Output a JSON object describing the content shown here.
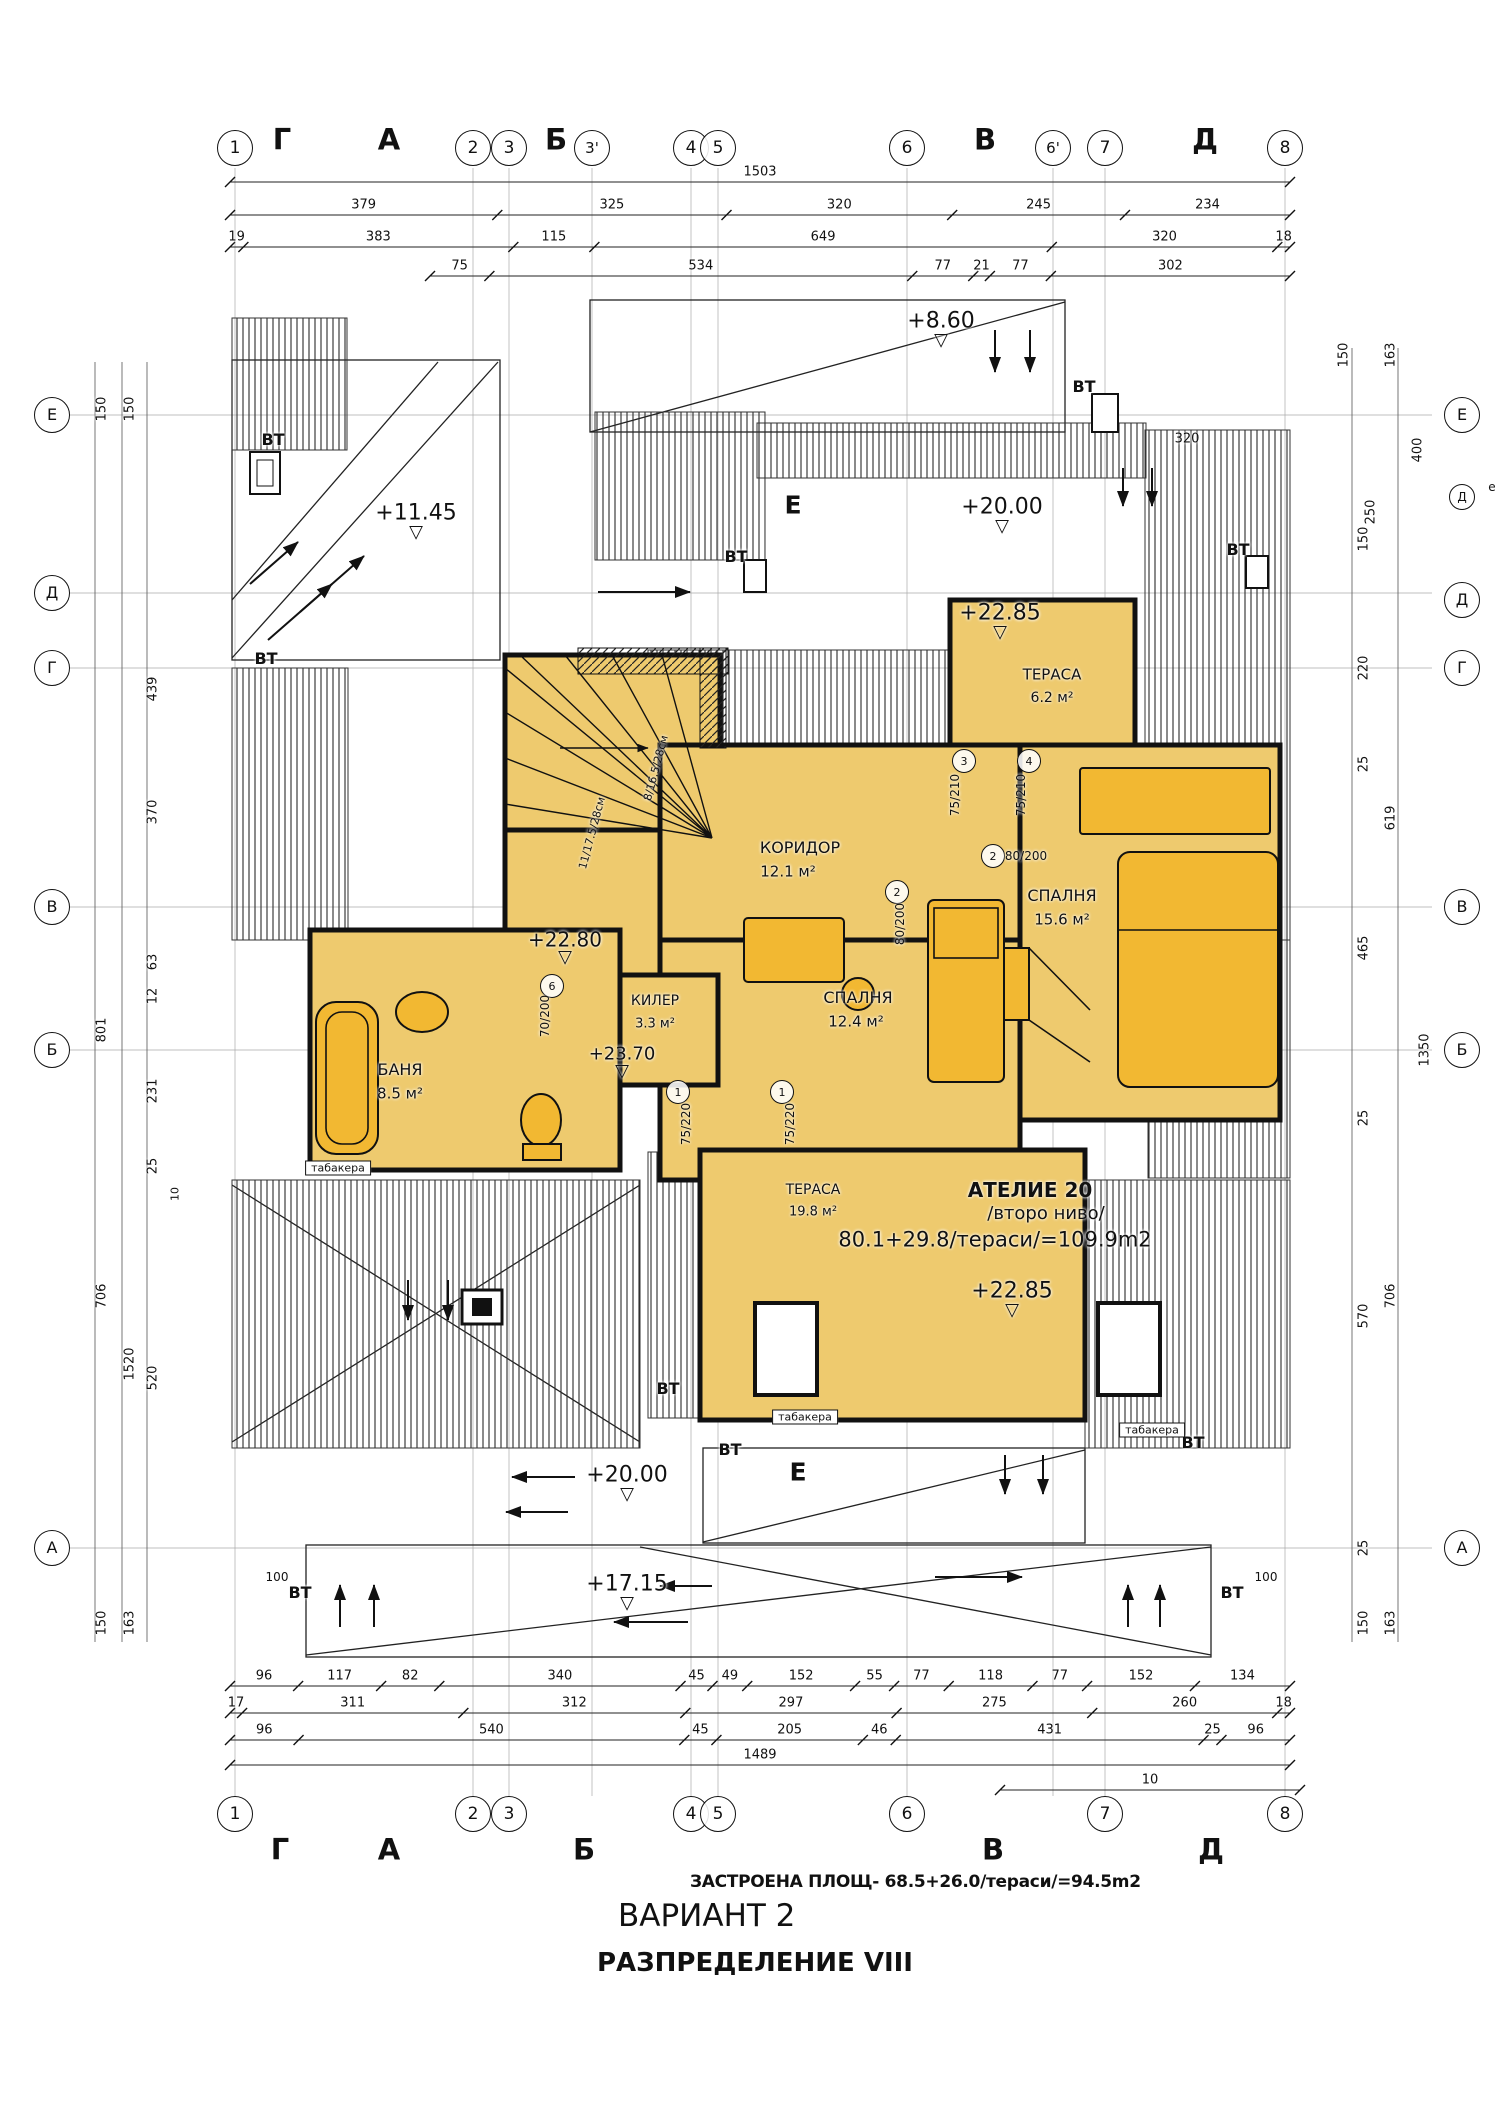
{
  "colors": {
    "room_fill": "#eeca6e",
    "furniture_fill": "#f2b832",
    "line": "#111111",
    "hatch": "#2a2a2a"
  },
  "title_block": {
    "built_area": "ЗАСТРОЕНА ПЛОЩ- 68.5+26.0/тераси/=94.5m2",
    "variant": "ВАРИАНТ 2",
    "layout": "РАЗПРЕДЕЛЕНИЕ VIII"
  },
  "dimension_rows": [
    {
      "name": "dim-top-overall",
      "y": 182,
      "x0": 230,
      "x1": 1290,
      "values": [
        "1503"
      ]
    },
    {
      "name": "dim-top-row2",
      "y": 215,
      "x0": 230,
      "x1": 1290,
      "values": [
        "379",
        "325",
        "320",
        "245",
        "234"
      ]
    },
    {
      "name": "dim-top-row3",
      "y": 247,
      "x0": 230,
      "x1": 1290,
      "values": [
        "19",
        "383",
        "115",
        "649",
        "320",
        "18"
      ]
    },
    {
      "name": "dim-top-row4",
      "y": 276,
      "x0": 430,
      "x1": 1290,
      "values": [
        "75",
        "534",
        "77",
        "21",
        "77",
        "302"
      ]
    },
    {
      "name": "dim-bottom-row1",
      "y": 1686,
      "x0": 230,
      "x1": 1290,
      "values": [
        "96",
        "117",
        "82",
        "340",
        "45",
        "49",
        "152",
        "55",
        "77",
        "118",
        "77",
        "152",
        "134"
      ]
    },
    {
      "name": "dim-bottom-row2",
      "y": 1713,
      "x0": 230,
      "x1": 1290,
      "values": [
        "17",
        "311",
        "312",
        "297",
        "275",
        "260",
        "18"
      ]
    },
    {
      "name": "dim-bottom-row3",
      "y": 1740,
      "x0": 230,
      "x1": 1290,
      "values": [
        "96",
        "540",
        "45",
        "205",
        "46",
        "431",
        "25",
        "96"
      ]
    },
    {
      "name": "dim-bottom-overall",
      "y": 1765,
      "x0": 230,
      "x1": 1290,
      "values": [
        "1489"
      ]
    },
    {
      "name": "dim-bottom-offset",
      "y": 1790,
      "x0": 1000,
      "x1": 1300,
      "values": [
        "10"
      ]
    }
  ],
  "labels": [
    {
      "n": "axis-top-1",
      "k": "bubble",
      "t": "1",
      "x": 235,
      "y": 148,
      "s": 17
    },
    {
      "n": "axis-top-letter-g",
      "t": "Г",
      "x": 282,
      "y": 140,
      "s": 29,
      "b": 1
    },
    {
      "n": "axis-top-letter-a",
      "t": "А",
      "x": 389,
      "y": 140,
      "s": 29,
      "b": 1
    },
    {
      "n": "axis-top-2",
      "k": "bubble",
      "t": "2",
      "x": 473,
      "y": 148,
      "s": 17
    },
    {
      "n": "axis-top-3",
      "k": "bubble",
      "t": "3",
      "x": 509,
      "y": 148,
      "s": 17
    },
    {
      "n": "axis-top-letter-b",
      "t": "Б",
      "x": 556,
      "y": 140,
      "s": 29,
      "b": 1
    },
    {
      "n": "axis-top-3p",
      "k": "bubble",
      "t": "3'",
      "x": 592,
      "y": 148,
      "s": 15
    },
    {
      "n": "axis-top-4",
      "k": "bubble",
      "t": "4",
      "x": 691,
      "y": 148,
      "s": 17
    },
    {
      "n": "axis-top-5",
      "k": "bubble",
      "t": "5",
      "x": 718,
      "y": 148,
      "s": 17
    },
    {
      "n": "axis-top-6",
      "k": "bubble",
      "t": "6",
      "x": 907,
      "y": 148,
      "s": 17
    },
    {
      "n": "axis-top-letter-v",
      "t": "В",
      "x": 985,
      "y": 140,
      "s": 29,
      "b": 1
    },
    {
      "n": "axis-top-6p",
      "k": "bubble",
      "t": "6'",
      "x": 1053,
      "y": 148,
      "s": 15
    },
    {
      "n": "axis-top-7",
      "k": "bubble",
      "t": "7",
      "x": 1105,
      "y": 148,
      "s": 17
    },
    {
      "n": "axis-top-letter-d",
      "t": "Д",
      "x": 1205,
      "y": 140,
      "s": 29,
      "b": 1
    },
    {
      "n": "axis-top-8",
      "k": "bubble",
      "t": "8",
      "x": 1285,
      "y": 148,
      "s": 17
    },
    {
      "n": "axis-bottom-1",
      "k": "bubble",
      "t": "1",
      "x": 235,
      "y": 1814,
      "s": 17
    },
    {
      "n": "axis-bottom-2",
      "k": "bubble",
      "t": "2",
      "x": 473,
      "y": 1814,
      "s": 17
    },
    {
      "n": "axis-bottom-3",
      "k": "bubble",
      "t": "3",
      "x": 509,
      "y": 1814,
      "s": 17
    },
    {
      "n": "axis-bottom-4",
      "k": "bubble",
      "t": "4",
      "x": 691,
      "y": 1814,
      "s": 17
    },
    {
      "n": "axis-bottom-5",
      "k": "bubble",
      "t": "5",
      "x": 718,
      "y": 1814,
      "s": 17
    },
    {
      "n": "axis-bottom-6",
      "k": "bubble",
      "t": "6",
      "x": 907,
      "y": 1814,
      "s": 17
    },
    {
      "n": "axis-bottom-7",
      "k": "bubble",
      "t": "7",
      "x": 1105,
      "y": 1814,
      "s": 17
    },
    {
      "n": "axis-bottom-8",
      "k": "bubble",
      "t": "8",
      "x": 1285,
      "y": 1814,
      "s": 17
    },
    {
      "n": "axis-bottom-letter-g",
      "t": "Г",
      "x": 280,
      "y": 1850,
      "s": 29,
      "b": 1
    },
    {
      "n": "axis-bottom-letter-a",
      "t": "А",
      "x": 389,
      "y": 1850,
      "s": 29,
      "b": 1
    },
    {
      "n": "axis-bottom-letter-b",
      "t": "Б",
      "x": 584,
      "y": 1850,
      "s": 29,
      "b": 1
    },
    {
      "n": "axis-bottom-letter-v",
      "t": "В",
      "x": 993,
      "y": 1850,
      "s": 29,
      "b": 1
    },
    {
      "n": "axis-bottom-letter-d",
      "t": "Д",
      "x": 1211,
      "y": 1850,
      "s": 29,
      "b": 1
    },
    {
      "n": "axis-left-e",
      "k": "bubble",
      "t": "Е",
      "x": 52,
      "y": 415,
      "s": 16
    },
    {
      "n": "axis-left-d",
      "k": "bubble",
      "t": "Д",
      "x": 52,
      "y": 593,
      "s": 16
    },
    {
      "n": "axis-left-g",
      "k": "bubble",
      "t": "Г",
      "x": 52,
      "y": 668,
      "s": 16
    },
    {
      "n": "axis-left-v",
      "k": "bubble",
      "t": "В",
      "x": 52,
      "y": 907,
      "s": 16
    },
    {
      "n": "axis-left-b",
      "k": "bubble",
      "t": "Б",
      "x": 52,
      "y": 1050,
      "s": 16
    },
    {
      "n": "axis-left-a",
      "k": "bubble",
      "t": "А",
      "x": 52,
      "y": 1548,
      "s": 16
    },
    {
      "n": "axis-right-e",
      "k": "bubble",
      "t": "Е",
      "x": 1462,
      "y": 415,
      "s": 16
    },
    {
      "n": "axis-right-d2",
      "k": "bubble",
      "t": "Д",
      "x": 1462,
      "y": 497,
      "s": 12,
      "d": 24
    },
    {
      "n": "axis-right-d",
      "k": "bubble",
      "t": "Д",
      "x": 1462,
      "y": 600,
      "s": 16
    },
    {
      "n": "axis-right-g",
      "k": "bubble",
      "t": "Г",
      "x": 1462,
      "y": 668,
      "s": 16
    },
    {
      "n": "axis-right-v",
      "k": "bubble",
      "t": "В",
      "x": 1462,
      "y": 907,
      "s": 16
    },
    {
      "n": "axis-right-b",
      "k": "bubble",
      "t": "Б",
      "x": 1462,
      "y": 1050,
      "s": 16
    },
    {
      "n": "axis-right-a",
      "k": "bubble",
      "t": "А",
      "x": 1462,
      "y": 1548,
      "s": 16
    },
    {
      "n": "axis-right-note",
      "t": "е",
      "x": 1492,
      "y": 487,
      "s": 12
    },
    {
      "n": "dim-left",
      "t": "150",
      "x": 102,
      "y": 409,
      "r": -90
    },
    {
      "n": "dim-left",
      "t": "150",
      "x": 130,
      "y": 409,
      "r": -90
    },
    {
      "n": "dim-left",
      "t": "439",
      "x": 153,
      "y": 689,
      "r": -90
    },
    {
      "n": "dim-left",
      "t": "370",
      "x": 153,
      "y": 812,
      "r": -90
    },
    {
      "n": "dim-left",
      "t": "63",
      "x": 153,
      "y": 962,
      "r": -90
    },
    {
      "n": "dim-left",
      "t": "12",
      "x": 153,
      "y": 996,
      "r": -90
    },
    {
      "n": "dim-left",
      "t": "801",
      "x": 102,
      "y": 1030,
      "r": -90
    },
    {
      "n": "dim-left",
      "t": "231",
      "x": 153,
      "y": 1091,
      "r": -90
    },
    {
      "n": "dim-left",
      "t": "25",
      "x": 153,
      "y": 1166,
      "r": -90
    },
    {
      "n": "dim-left",
      "t": "10",
      "x": 175,
      "y": 1194,
      "r": -90,
      "s": 11
    },
    {
      "n": "dim-left",
      "t": "706",
      "x": 102,
      "y": 1296,
      "r": -90
    },
    {
      "n": "dim-left",
      "t": "1520",
      "x": 130,
      "y": 1364,
      "r": -90
    },
    {
      "n": "dim-left",
      "t": "520",
      "x": 153,
      "y": 1378,
      "r": -90
    },
    {
      "n": "dim-left",
      "t": "150",
      "x": 102,
      "y": 1623,
      "r": -90
    },
    {
      "n": "dim-left",
      "t": "163",
      "x": 130,
      "y": 1623,
      "r": -90
    },
    {
      "n": "dim-right",
      "t": "150",
      "x": 1344,
      "y": 355,
      "r": -90
    },
    {
      "n": "dim-right",
      "t": "163",
      "x": 1391,
      "y": 355,
      "r": -90
    },
    {
      "n": "dim-right",
      "t": "320",
      "x": 1187,
      "y": 439,
      "s": 13
    },
    {
      "n": "dim-right",
      "t": "400",
      "x": 1418,
      "y": 450,
      "r": -90
    },
    {
      "n": "dim-right",
      "t": "250",
      "x": 1371,
      "y": 512,
      "r": -90
    },
    {
      "n": "dim-right",
      "t": "150",
      "x": 1364,
      "y": 539,
      "r": -90
    },
    {
      "n": "dim-right",
      "t": "220",
      "x": 1364,
      "y": 668,
      "r": -90
    },
    {
      "n": "dim-right",
      "t": "25",
      "x": 1364,
      "y": 764,
      "r": -90
    },
    {
      "n": "dim-right",
      "t": "619",
      "x": 1391,
      "y": 818,
      "r": -90
    },
    {
      "n": "dim-right",
      "t": "465",
      "x": 1364,
      "y": 948,
      "r": -90
    },
    {
      "n": "dim-right",
      "t": "1350",
      "x": 1425,
      "y": 1050,
      "r": -90
    },
    {
      "n": "dim-right",
      "t": "25",
      "x": 1364,
      "y": 1118,
      "r": -90
    },
    {
      "n": "dim-right",
      "t": "706",
      "x": 1391,
      "y": 1296,
      "r": -90
    },
    {
      "n": "dim-right",
      "t": "570",
      "x": 1364,
      "y": 1316,
      "r": -90
    },
    {
      "n": "dim-right",
      "t": "25",
      "x": 1364,
      "y": 1548,
      "r": -90
    },
    {
      "n": "dim-right",
      "t": "150",
      "x": 1364,
      "y": 1623,
      "r": -90
    },
    {
      "n": "dim-right",
      "t": "163",
      "x": 1391,
      "y": 1623,
      "r": -90
    },
    {
      "n": "elevation-mark",
      "k": "elev",
      "t": "+8.60",
      "x": 941,
      "y": 330,
      "s": 22
    },
    {
      "n": "elevation-mark",
      "k": "elev",
      "t": "+11.45",
      "x": 416,
      "y": 522,
      "s": 22
    },
    {
      "n": "elevation-mark",
      "k": "elev",
      "t": "+20.00",
      "x": 1002,
      "y": 516,
      "s": 22
    },
    {
      "n": "elevation-mark",
      "k": "elev",
      "t": "+22.85",
      "x": 1000,
      "y": 622,
      "s": 22
    },
    {
      "n": "elevation-mark",
      "k": "elev",
      "t": "+22.80",
      "x": 565,
      "y": 948,
      "s": 20
    },
    {
      "n": "elevation-mark",
      "k": "elev",
      "t": "+23.70",
      "x": 622,
      "y": 1063,
      "s": 18
    },
    {
      "n": "elevation-mark",
      "k": "elev",
      "t": "+22.85",
      "x": 1012,
      "y": 1300,
      "s": 22
    },
    {
      "n": "elevation-mark",
      "k": "elev",
      "t": "+20.00",
      "x": 627,
      "y": 1484,
      "s": 22
    },
    {
      "n": "elevation-mark",
      "k": "elev",
      "t": "+17.15",
      "x": 627,
      "y": 1593,
      "s": 22
    },
    {
      "n": "room-name-terrace-top",
      "t": "ТЕРАСА",
      "x": 1052,
      "y": 675,
      "s": 15
    },
    {
      "n": "room-area-terrace-top",
      "t": "6.2 м²",
      "x": 1052,
      "y": 698,
      "s": 14
    },
    {
      "n": "room-name-corridor",
      "t": "КОРИДОР",
      "x": 800,
      "y": 848,
      "s": 16
    },
    {
      "n": "room-area-corridor",
      "t": "12.1 м²",
      "x": 788,
      "y": 872,
      "s": 15
    },
    {
      "n": "room-name-bedroom-right",
      "t": "СПАЛНЯ",
      "x": 1062,
      "y": 896,
      "s": 16
    },
    {
      "n": "room-area-bedroom-right",
      "t": "15.6 м²",
      "x": 1062,
      "y": 920,
      "s": 15
    },
    {
      "n": "room-name-closet",
      "t": "КИЛЕР",
      "x": 655,
      "y": 1001,
      "s": 14
    },
    {
      "n": "room-area-closet",
      "t": "3.3 м²",
      "x": 655,
      "y": 1024,
      "s": 13
    },
    {
      "n": "room-name-bedroom-center",
      "t": "СПАЛНЯ",
      "x": 858,
      "y": 998,
      "s": 16
    },
    {
      "n": "room-area-bedroom-center",
      "t": "12.4 м²",
      "x": 856,
      "y": 1022,
      "s": 15
    },
    {
      "n": "room-name-bath",
      "t": "БАНЯ",
      "x": 400,
      "y": 1070,
      "s": 16
    },
    {
      "n": "room-area-bath",
      "t": "8.5 м²",
      "x": 400,
      "y": 1094,
      "s": 15
    },
    {
      "n": "room-name-terrace-bottom",
      "t": "ТЕРАСА",
      "x": 813,
      "y": 1190,
      "s": 14
    },
    {
      "n": "room-area-terrace-bottom",
      "t": "19.8 м²",
      "x": 813,
      "y": 1212,
      "s": 13
    },
    {
      "n": "atelier-title",
      "t": "АТЕЛИЕ 20",
      "x": 1030,
      "y": 1190,
      "s": 20,
      "b": 1
    },
    {
      "n": "atelier-level-note",
      "t": "/второ ниво/",
      "x": 1046,
      "y": 1214,
      "s": 18
    },
    {
      "n": "atelier-area-note",
      "t": "80.1+29.8/тераси/=109.9m2",
      "x": 995,
      "y": 1240,
      "s": 21
    },
    {
      "n": "door-tag",
      "k": "bubble",
      "t": "3",
      "x": 964,
      "y": 761,
      "s": 11,
      "d": 22
    },
    {
      "n": "door-size",
      "t": "75/210",
      "x": 955,
      "y": 795,
      "r": -90,
      "s": 12
    },
    {
      "n": "door-tag",
      "k": "bubble",
      "t": "4",
      "x": 1029,
      "y": 761,
      "s": 11,
      "d": 22
    },
    {
      "n": "door-size",
      "t": "75/210",
      "x": 1021,
      "y": 795,
      "r": -90,
      "s": 12
    },
    {
      "n": "door-tag",
      "k": "bubble",
      "t": "2",
      "x": 993,
      "y": 856,
      "s": 11,
      "d": 22
    },
    {
      "n": "door-size",
      "t": "80/200",
      "x": 1026,
      "y": 856,
      "s": 12
    },
    {
      "n": "door-tag",
      "k": "bubble",
      "t": "2",
      "x": 897,
      "y": 892,
      "s": 11,
      "d": 22
    },
    {
      "n": "door-size",
      "t": "80/200",
      "x": 900,
      "y": 924,
      "r": -90,
      "s": 12
    },
    {
      "n": "door-tag",
      "k": "bubble",
      "t": "6",
      "x": 552,
      "y": 986,
      "s": 11,
      "d": 22
    },
    {
      "n": "door-size",
      "t": "70/200",
      "x": 545,
      "y": 1016,
      "r": -90,
      "s": 12
    },
    {
      "n": "door-tag",
      "k": "bubble",
      "t": "1",
      "x": 678,
      "y": 1092,
      "s": 11,
      "d": 22
    },
    {
      "n": "door-size",
      "t": "75/220",
      "x": 686,
      "y": 1124,
      "r": -90,
      "s": 12
    },
    {
      "n": "door-tag",
      "k": "bubble",
      "t": "1",
      "x": 782,
      "y": 1092,
      "s": 11,
      "d": 22
    },
    {
      "n": "door-size",
      "t": "75/220",
      "x": 790,
      "y": 1124,
      "r": -90,
      "s": 12
    },
    {
      "n": "vent-label",
      "t": "ВТ",
      "x": 273,
      "y": 440,
      "s": 16,
      "b": 1
    },
    {
      "n": "vent-label",
      "t": "ВТ",
      "x": 1084,
      "y": 387,
      "s": 16,
      "b": 1
    },
    {
      "n": "vent-label",
      "t": "ВТ",
      "x": 736,
      "y": 557,
      "s": 16,
      "b": 1
    },
    {
      "n": "vent-label",
      "t": "ВТ",
      "x": 1238,
      "y": 550,
      "s": 16,
      "b": 1
    },
    {
      "n": "vent-label",
      "t": "ВТ",
      "x": 266,
      "y": 659,
      "s": 16,
      "b": 1
    },
    {
      "n": "vent-label",
      "t": "ВТ",
      "x": 668,
      "y": 1389,
      "s": 16,
      "b": 1
    },
    {
      "n": "vent-label",
      "t": "ВТ",
      "x": 730,
      "y": 1450,
      "s": 16,
      "b": 1
    },
    {
      "n": "vent-label",
      "t": "ВТ",
      "x": 1193,
      "y": 1443,
      "s": 16,
      "b": 1
    },
    {
      "n": "vent-label",
      "t": "ВТ",
      "x": 300,
      "y": 1593,
      "s": 16,
      "b": 1
    },
    {
      "n": "vent-label",
      "t": "ВТ",
      "x": 1232,
      "y": 1593,
      "s": 16,
      "b": 1
    },
    {
      "n": "offset-note",
      "t": "100",
      "x": 277,
      "y": 1577,
      "s": 12
    },
    {
      "n": "offset-note",
      "t": "100",
      "x": 1266,
      "y": 1577,
      "s": 12
    },
    {
      "n": "tabakera-label",
      "k": "box",
      "t": "табакера",
      "x": 338,
      "y": 1168,
      "s": 11
    },
    {
      "n": "tabakera-label",
      "k": "box",
      "t": "табакера",
      "x": 805,
      "y": 1417,
      "s": 11
    },
    {
      "n": "tabakera-label",
      "k": "box",
      "t": "табакера",
      "x": 1152,
      "y": 1430,
      "s": 11
    },
    {
      "n": "section-mark",
      "t": "Е",
      "x": 793,
      "y": 505,
      "s": 25,
      "b": 1
    },
    {
      "n": "section-mark",
      "t": "Е",
      "x": 798,
      "y": 1472,
      "s": 25,
      "b": 1
    },
    {
      "n": "stair-note",
      "t": "8/16.5/28см",
      "x": 656,
      "y": 768,
      "r": -75,
      "s": 11
    },
    {
      "n": "stair-note",
      "t": "11/17.5/28см",
      "x": 592,
      "y": 833,
      "r": -75,
      "s": 11
    }
  ]
}
